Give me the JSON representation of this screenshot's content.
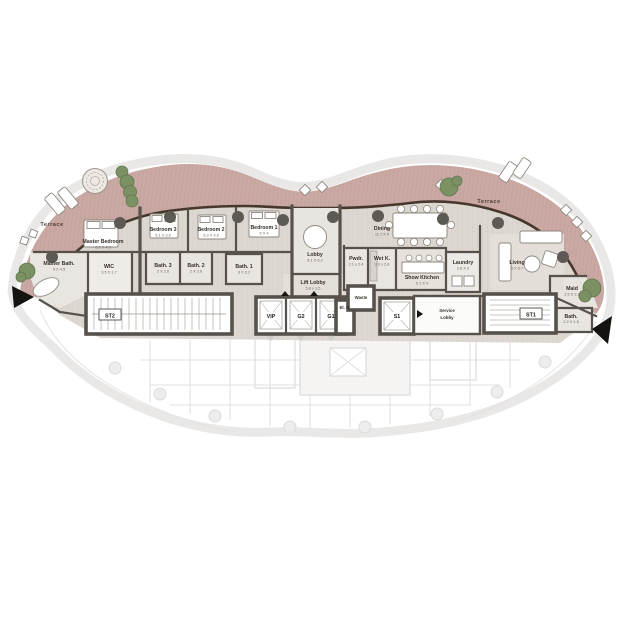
{
  "palette": {
    "terrace": "#caa8a3",
    "terrace_stripe": "#bb978f",
    "wood_floor": "#dcd7d0",
    "bath_floor": "#e9e6e2",
    "wall": "#56524b",
    "facade_line": "#46372c",
    "ghost": "#e4e2e0",
    "tree_green": "#7b9164",
    "column": "#5d5a55"
  },
  "rooms": {
    "terrace_left": {
      "name": "Terrace"
    },
    "terrace_right": {
      "name": "Terrace"
    },
    "master_bedroom": {
      "name": "Master Bedroom",
      "dim": "6.2 X 4.5"
    },
    "wic": {
      "name": "WIC",
      "dim": "3.5 X 1.7"
    },
    "master_bath": {
      "name": "Master Bath.",
      "dim": "4 X 4.5"
    },
    "bedroom3": {
      "name": "Bedroom 3",
      "dim": "5.1 X 3.6"
    },
    "bath3": {
      "name": "Bath. 3",
      "dim": "2 X 2.6"
    },
    "bedroom2": {
      "name": "Bedroom 2",
      "dim": "5.3 X 3.6"
    },
    "bath2": {
      "name": "Bath. 2",
      "dim": "2 X 2.6"
    },
    "bedroom1": {
      "name": "Bedroom 1",
      "dim": "5 X 4"
    },
    "bath1": {
      "name": "Bath. 1",
      "dim": "3 X 2.2"
    },
    "lobby": {
      "name": "Lobby",
      "dim": "6.1 X 6.2"
    },
    "lift_lobby": {
      "name": "Lift Lobby",
      "dim": "5.8 x 1.5"
    },
    "pwdr": {
      "name": "Pwdr.",
      "dim": "2.1 x 2.4"
    },
    "wet_kitchen": {
      "name": "Wet K.",
      "dim": "3.3 x 2.8"
    },
    "dining": {
      "name": "Dining",
      "dim": "11.7 X 4"
    },
    "show_kitchen": {
      "name": "Show Kitchen",
      "dim": "5.1 X 4"
    },
    "laundry": {
      "name": "Laundry",
      "dim": "2.8 X 2"
    },
    "living": {
      "name": "Living",
      "dim": "6 X 6.7"
    },
    "maid": {
      "name": "Maid",
      "dim": "2.5 X 2.2"
    },
    "maid_bath": {
      "name": "Bath.",
      "dim": "2.2 X 1.5"
    },
    "electrical": {
      "name": "El. R."
    },
    "waste": {
      "name": "Waste"
    },
    "service_lobby": {
      "line1": "Service",
      "line2": "Lobby"
    }
  },
  "lifts": {
    "vip": "VIP",
    "g2": "G2",
    "g1": "G1",
    "s1": "S1"
  },
  "stairs": {
    "st1": "ST1",
    "st2": "ST2"
  }
}
